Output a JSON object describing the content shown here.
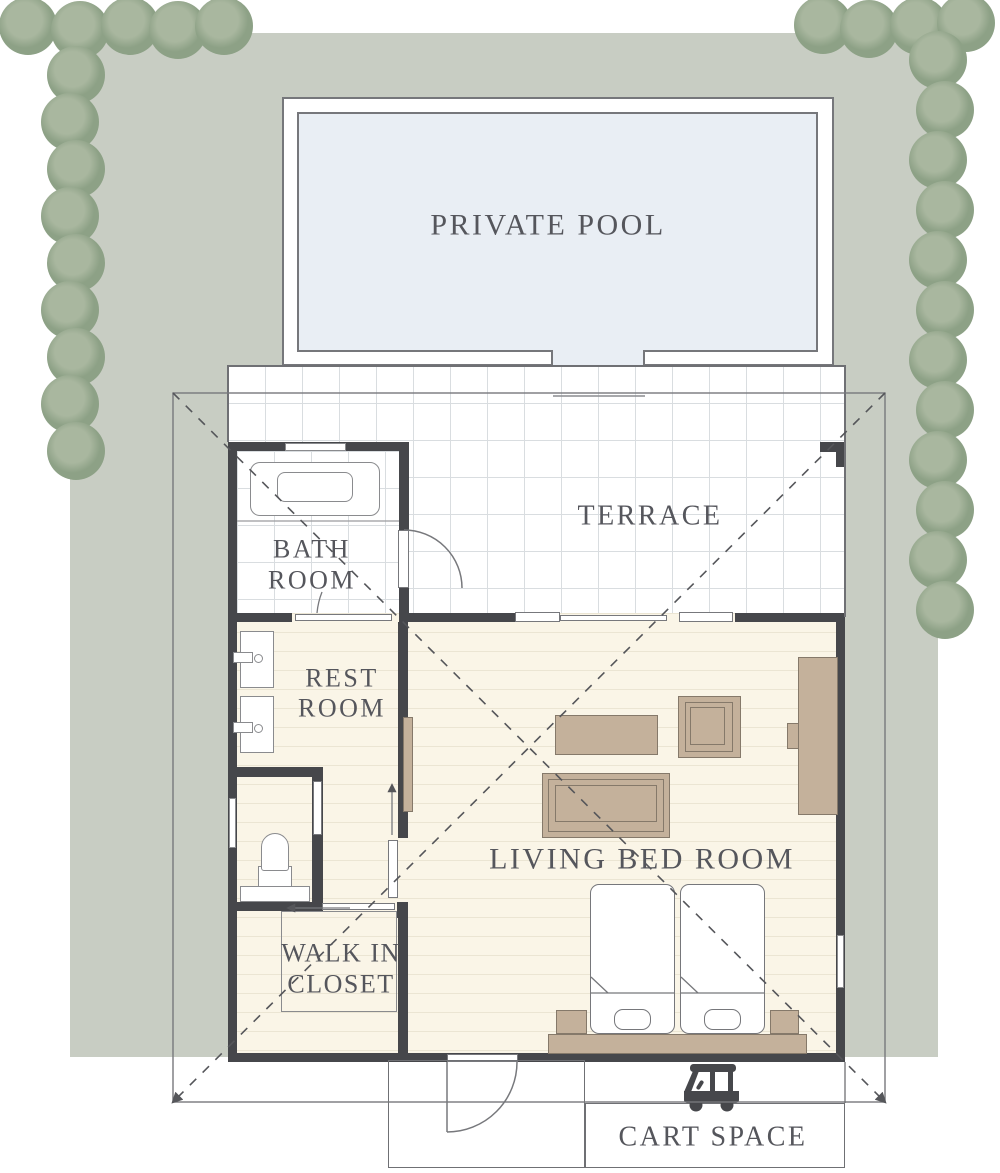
{
  "rooms": {
    "private_pool": {
      "label": "PRIVATE POOL"
    },
    "terrace": {
      "label": "TERRACE"
    },
    "bath_room": {
      "line1": "BATH",
      "line2": "ROOM"
    },
    "rest_room": {
      "line1": "REST",
      "line2": "ROOM"
    },
    "living_bed_room": {
      "label": "LIVING BED ROOM"
    },
    "walk_in_closet": {
      "line1": "WALK IN",
      "line2": "CLOSET"
    },
    "cart_space": {
      "label": "CART SPACE"
    }
  },
  "icons": {
    "cart": "golf-cart-icon",
    "tree": "tree-icon"
  },
  "colors": {
    "land": "#c8cdc3",
    "tree_dark": "#8da186",
    "tree_light": "#a9b79f",
    "pool_water": "#e9eef4",
    "wall": "#46474b",
    "floor_cream": "#faf5e7",
    "tile_grid": "#d9dde0",
    "furniture_tan": "#c4b19b",
    "furniture_outline": "#85796a",
    "thin_line": "#6f7074",
    "dash_line": "#55565a",
    "label_text": "#55565c"
  }
}
